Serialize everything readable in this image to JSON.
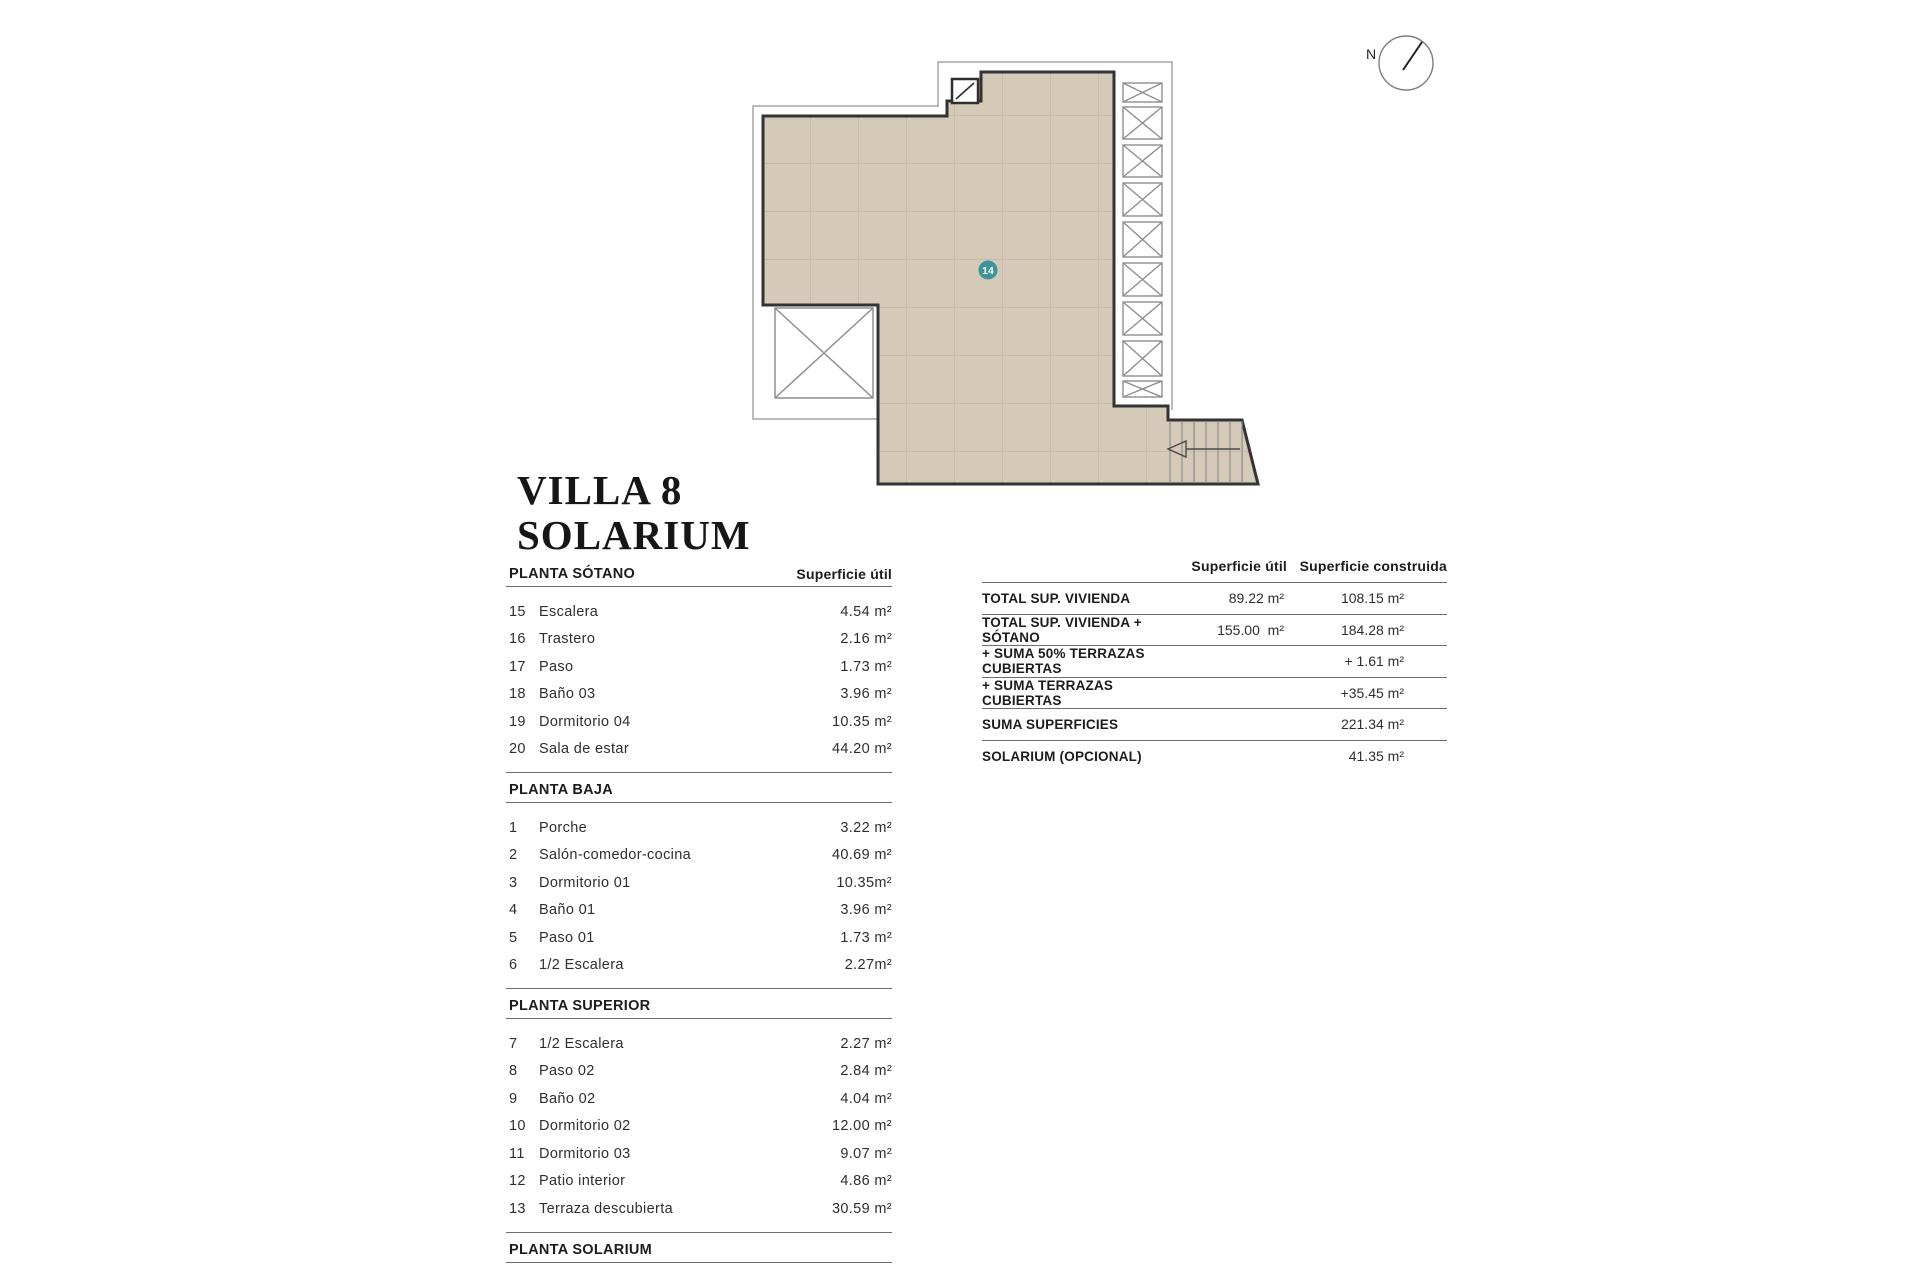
{
  "title": {
    "line1": "VILLA 8",
    "line2": "SOLARIUM"
  },
  "plan": {
    "unit_badge": "14",
    "compass_label": "N",
    "colors": {
      "floor_fill": "#d5c9b8",
      "grid_line": "#c8bbaa",
      "wall": "#333333",
      "thin_line": "#a3a3a3",
      "badge": "#3a969c"
    }
  },
  "left_table": {
    "value_header": "Superficie útil",
    "sections": [
      {
        "header": "PLANTA SÓTANO",
        "rows": [
          {
            "num": "15",
            "label": "Escalera",
            "value": "4.54 m²"
          },
          {
            "num": "16",
            "label": "Trastero",
            "value": "2.16 m²"
          },
          {
            "num": "17",
            "label": "Paso",
            "value": "1.73 m²"
          },
          {
            "num": "18",
            "label": "Baño 03",
            "value": "3.96 m²"
          },
          {
            "num": "19",
            "label": "Dormitorio 04",
            "value": "10.35 m²"
          },
          {
            "num": "20",
            "label": "Sala de estar",
            "value": "44.20 m²"
          }
        ]
      },
      {
        "header": "PLANTA BAJA",
        "rows": [
          {
            "num": "1",
            "label": "Porche",
            "value": "3.22 m²"
          },
          {
            "num": "2",
            "label": "Salón-comedor-cocina",
            "value": "40.69 m²"
          },
          {
            "num": "3",
            "label": "Dormitorio 01",
            "value": "10.35m²"
          },
          {
            "num": "4",
            "label": "Baño 01",
            "value": "3.96 m²"
          },
          {
            "num": "5",
            "label": "Paso 01",
            "value": "1.73 m²"
          },
          {
            "num": "6",
            "label": "1/2 Escalera",
            "value": "2.27m²"
          }
        ]
      },
      {
        "header": "PLANTA SUPERIOR",
        "rows": [
          {
            "num": "7",
            "label": "1/2 Escalera",
            "value": "2.27 m²"
          },
          {
            "num": "8",
            "label": "Paso 02",
            "value": "2.84 m²"
          },
          {
            "num": "9",
            "label": "Baño 02",
            "value": "4.04 m²"
          },
          {
            "num": "10",
            "label": "Dormitorio 02",
            "value": "12.00 m²"
          },
          {
            "num": "11",
            "label": "Dormitorio 03",
            "value": "9.07 m²"
          },
          {
            "num": "12",
            "label": "Patio interior",
            "value": "4.86 m²"
          },
          {
            "num": "13",
            "label": "Terraza descubierta",
            "value": "30.59 m²"
          }
        ]
      },
      {
        "header": "PLANTA SOLARIUM",
        "rows": [
          {
            "num": "14",
            "label": "SOLARIUM",
            "value": "41.35 m²"
          }
        ]
      }
    ]
  },
  "summary_table": {
    "col_util": "Superficie útil",
    "col_construida": "Superficie construida",
    "rows": [
      {
        "label": "TOTAL SUP. VIVIENDA",
        "util": "89.22 m²",
        "construida": "108.15 m²"
      },
      {
        "label": "TOTAL SUP. VIVIENDA + SÓTANO",
        "util": "155.00  m²",
        "construida": "184.28 m²"
      },
      {
        "label": "+ SUMA 50% TERRAZAS CUBIERTAS",
        "util": "",
        "construida": "+ 1.61 m²"
      },
      {
        "label": "+ SUMA TERRAZAS CUBIERTAS",
        "util": "",
        "construida": "+35.45 m²"
      },
      {
        "label": "SUMA SUPERFICIES",
        "util": "",
        "construida": "221.34 m²"
      },
      {
        "label": "SOLARIUM (OPCIONAL)",
        "util": "",
        "construida": "41.35 m²"
      }
    ]
  }
}
